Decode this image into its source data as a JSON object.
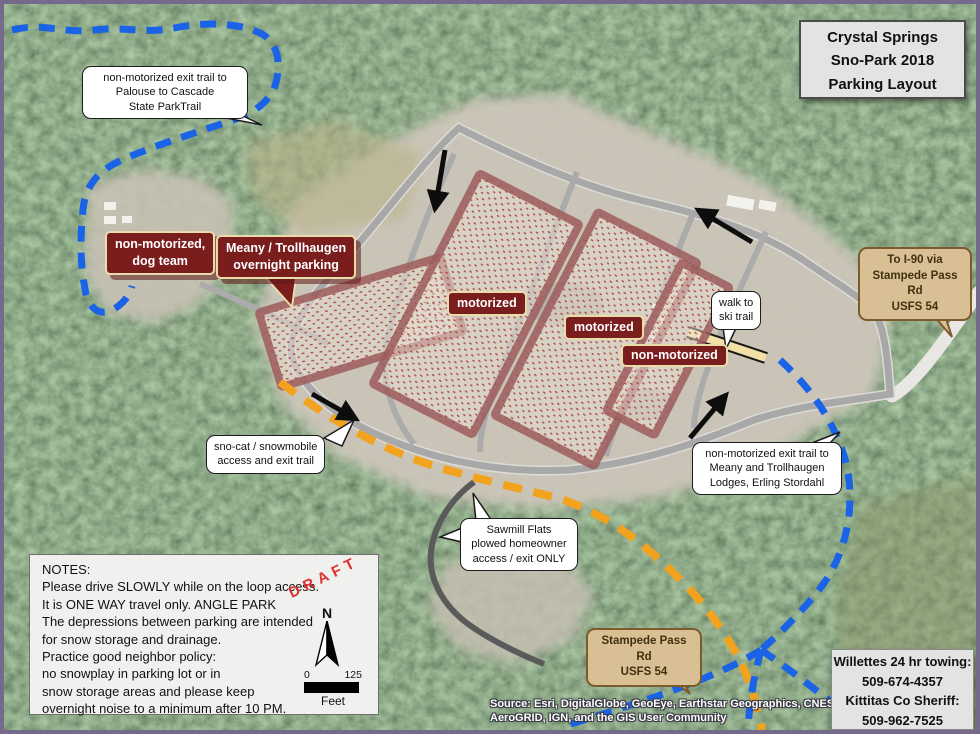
{
  "title": "Crystal Springs\nSno-Park 2018\nParking Layout",
  "labels": {
    "dog_team": "non-motorized,\ndog team",
    "meany_overnight": "Meany / Trollhaugen\novernight parking",
    "motorized_1": "motorized",
    "motorized_2": "motorized",
    "non_motorized": "non-motorized"
  },
  "callouts": {
    "palouse": "non-motorized exit trail to\nPalouse to Cascade\nState ParkTrail",
    "walk_ski": "walk to\nski trail",
    "snocat": "sno-cat / snowmobile\naccess and exit trail",
    "meany_exit": "non-motorized exit trail to\nMeany and Trollhaugen\nLodges, Erling Stordahl",
    "sawmill": "Sawmill Flats\nplowed homeowner\naccess / exit ONLY",
    "to_i90": "To I-90 via\nStampede Pass Rd\nUSFS 54",
    "stampede_rd": "Stampede Pass Rd\nUSFS 54"
  },
  "notes": {
    "heading": "NOTES:",
    "body": "Please drive SLOWLY while on the loop access.\nIt is ONE WAY travel only. ANGLE PARK\nThe depressions between parking are intended\nfor snow storage and drainage.\nPractice good neighbor policy:\nno snowplay in parking lot or in\nsnow storage areas and please keep\novernight noise to a minimum after 10 PM."
  },
  "draft": "DRAFT",
  "compass_north": "N",
  "scale": {
    "start": "0",
    "end": "125",
    "unit": "Feet"
  },
  "contacts": "Willettes 24 hr towing:\n509-674-4357\nKittitas Co Sheriff:\n509-962-7525",
  "attribution": "Source: Esri, DigitalGlobe, GeoEye, Earthstar Geographics, CNES/Airbus\nAeroGRID, IGN, and the GIS User Community",
  "colors": {
    "trail_non_motorized_blue": "#1b63e6",
    "trail_snocat_orange": "#f2a21c",
    "parking_outline": "#9c5c5c",
    "label_maroon": "#7a1d1d",
    "road_gray": "#a8a8a8",
    "callout_tan": "#d9c094",
    "draft_red": "#e03131",
    "frame_purple": "#756a8c"
  }
}
